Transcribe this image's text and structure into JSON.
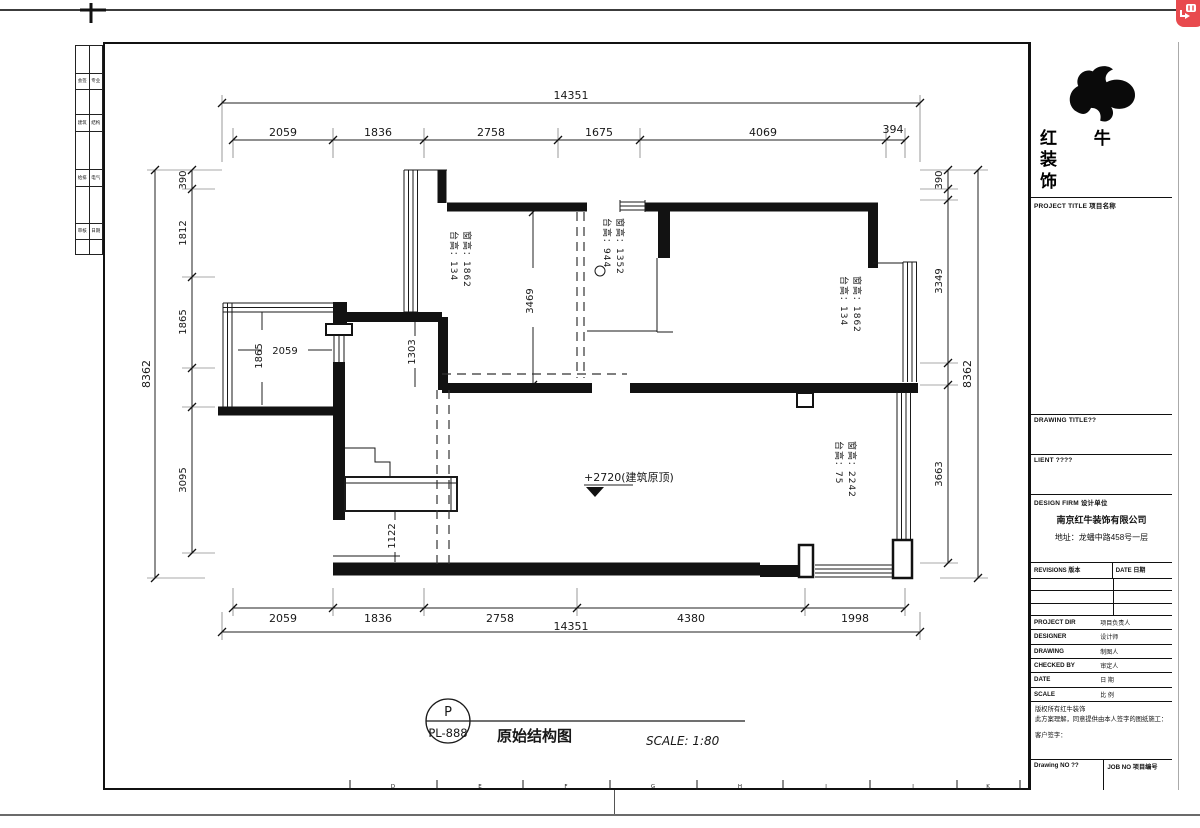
{
  "overlay": {
    "badge": "image-translate"
  },
  "left_margin": {
    "rows": [
      [
        "会签",
        "专业"
      ],
      [
        "建筑",
        "结构"
      ],
      [
        "给排",
        "电气"
      ],
      [
        "审核",
        "日期"
      ]
    ]
  },
  "plan": {
    "top_total": "14351",
    "top_segments": [
      "2059",
      "1836",
      "2758",
      "1675",
      "4069",
      "394"
    ],
    "bottom_segments": [
      "2059",
      "1836",
      "2758",
      "4380",
      "1998"
    ],
    "bottom_total": "14351",
    "left_total": "8362",
    "left_segments": [
      "390",
      "1812",
      "1865",
      "3095"
    ],
    "right_segments": [
      "390",
      "3349",
      "3663"
    ],
    "right_total": "8362",
    "interior_dims": {
      "room_height": "3469",
      "bay_width": "2059",
      "bay_height": "1865",
      "wall_offset": "1303",
      "shaft_offset": "1122"
    },
    "window_notes": {
      "w1_line1": "台高：134",
      "w1_line2": "窗高：1862",
      "w2_line1": "台高：944",
      "w2_line2": "窗高：1352",
      "w3_line1": "台高：134",
      "w3_line2": "窗高：1862",
      "w4_line1": "台高：75",
      "w4_line2": "窗高：2242"
    },
    "level_note": "+2720(建筑原顶)",
    "axis_letters": [
      "D",
      "E",
      "F",
      "G",
      "H",
      "I",
      "J",
      "K"
    ]
  },
  "title_bar": {
    "bubble_top": "P",
    "bubble_bottom": "PL-888",
    "drawing_title": "原始结构图",
    "scale_text": "SCALE: 1:80"
  },
  "titleblock": {
    "brand_line1": "红 牛 装",
    "brand_line2": "饰",
    "sections": {
      "project_title": "PROJECT TITLE 项目名称",
      "drawing_title": "DRAWING TITLE??",
      "client": "LIENT ????",
      "design_firm": "DESIGN FIRM 设计单位"
    },
    "company": "南京红牛装饰有限公司",
    "address": "地址：龙蟠中路458号一层",
    "revisions": {
      "left": "REVISIONS 版本",
      "right": "DATE 日期"
    },
    "info_rows": [
      {
        "en": "PROJECT DIR",
        "cn": "项目负责人"
      },
      {
        "en": "DESIGNER",
        "cn": "设计师"
      },
      {
        "en": "DRAWING",
        "cn": "制图人"
      },
      {
        "en": "CHECKED BY",
        "cn": "审定人"
      },
      {
        "en": "DATE",
        "cn": "日 期"
      },
      {
        "en": "SCALE",
        "cn": "比 例"
      }
    ],
    "disclaimer": [
      "版权所有红牛装饰",
      "此方案理解，同意提供由本人签字的图纸施工：",
      "客户签字："
    ],
    "footer": {
      "left": "Drawing NO ??",
      "right": "JOB NO 项目编号"
    }
  }
}
